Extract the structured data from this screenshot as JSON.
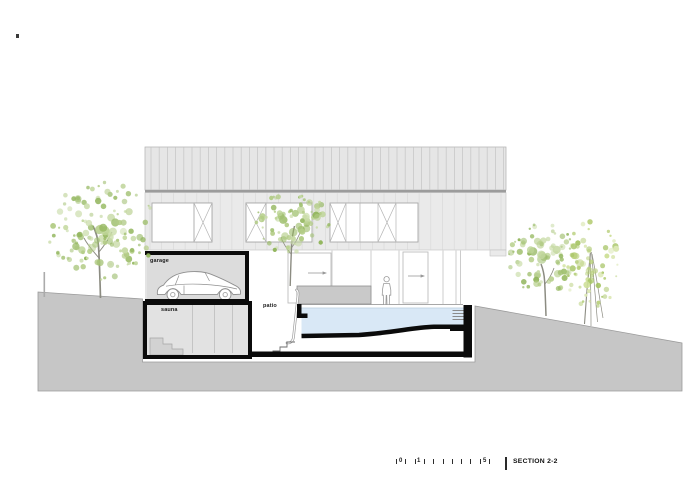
{
  "drawing": {
    "room_labels": {
      "garage": "garage",
      "sauna": "sauna",
      "patio": "patio"
    },
    "colors": {
      "ground": "#c6c6c6",
      "ground_edge": "#9b9b9b",
      "roof_band": "#e6e6e6",
      "facade_band": "#eaeaea",
      "garage_fill": "#dcdcdc",
      "sauna_fill": "#e2e2e2",
      "bench_fill": "#c9c9c9",
      "pool_water": "#d9e8f6",
      "outline": "#0b0b0b",
      "foliage": "#a9c47f"
    }
  },
  "title_block": {
    "section_label": "SECTION 2-2",
    "scale": {
      "tick_count": 11,
      "tick_spacing_px": 9.3,
      "numbers": [
        {
          "text": "0",
          "offset": 3
        },
        {
          "text": "1",
          "offset": 21
        },
        {
          "text": "5",
          "offset": 87
        }
      ]
    }
  }
}
